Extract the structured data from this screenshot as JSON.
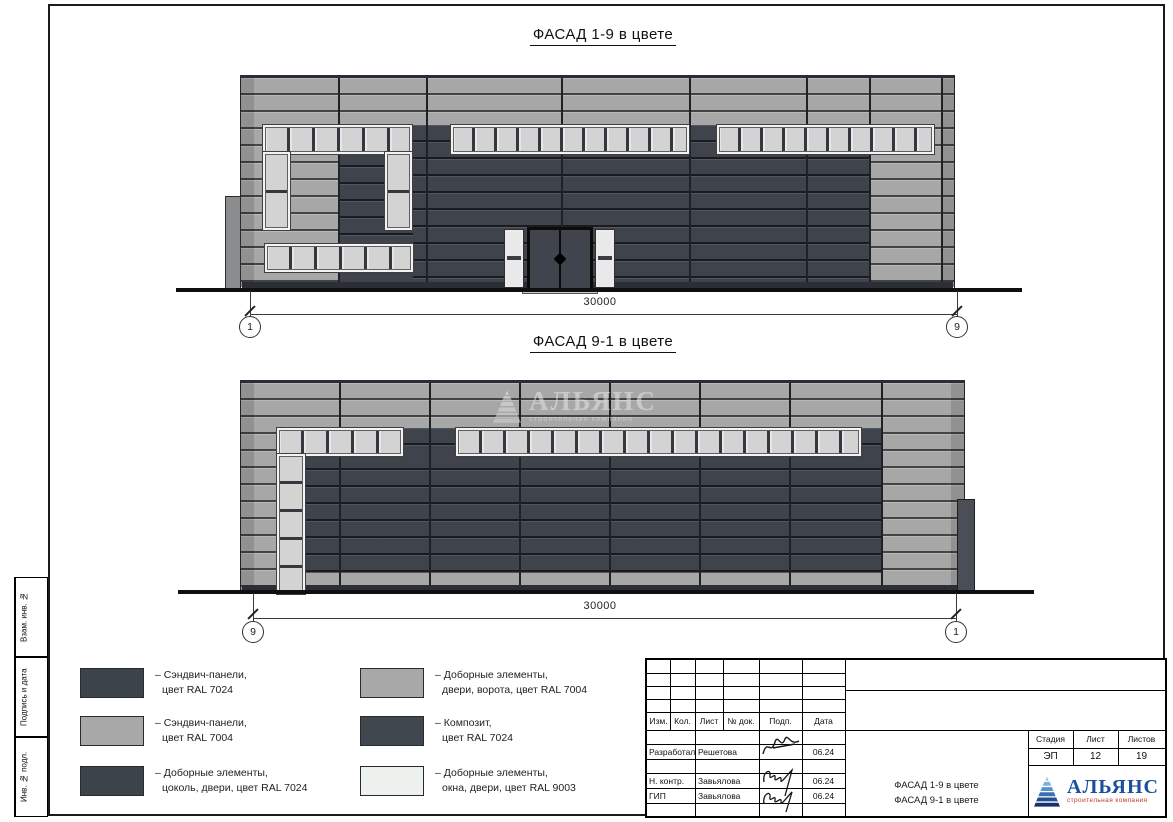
{
  "page": {
    "facades": [
      {
        "title": "ФАСАД 1-9 в цвете",
        "dimension": "30000",
        "axis_left": "1",
        "axis_right": "9"
      },
      {
        "title": "ФАСАД 9-1 в цвете",
        "dimension": "30000",
        "axis_left": "9",
        "axis_right": "1"
      }
    ],
    "watermark": {
      "name": "АЛЬЯНС",
      "subtitle": "строительная компания"
    }
  },
  "legend": {
    "left": [
      {
        "color": "#3d434b",
        "line1": "– Сэндвич-панели,",
        "line2": "цвет RAL 7024"
      },
      {
        "color": "#a8a8a8",
        "line1": "– Сэндвич-панели,",
        "line2": "цвет RAL 7004"
      },
      {
        "color": "#3d434b",
        "line1": "– Доборные элементы,",
        "line2": "цоколь, двери, цвет RAL 7024"
      }
    ],
    "right": [
      {
        "color": "#a8a8a8",
        "line1": "– Доборные элементы,",
        "line2": "двери, ворота, цвет RAL 7004"
      },
      {
        "color": "#41474f",
        "line1": "– Композит,",
        "line2": "цвет RAL 7024"
      },
      {
        "color": "#edf1ee",
        "line1": "– Доборные элементы,",
        "line2": "окна, двери, цвет RAL 9003"
      }
    ]
  },
  "titleblock": {
    "columns": [
      "Изм.",
      "Кол.",
      "Лист",
      "№ док.",
      "Подп.",
      "Дата"
    ],
    "rows": [
      {
        "role": "Разработал",
        "name": "Решетова",
        "date": "06.24"
      },
      {
        "role": "Н. контр.",
        "name": "Завьялова",
        "date": "06.24"
      },
      {
        "role": "ГИП",
        "name": "Завьялова",
        "date": "06.24"
      }
    ],
    "stage_label": "Стадия",
    "sheet_label": "Лист",
    "sheets_label": "Листов",
    "stage": "ЭП",
    "sheet_no": "12",
    "sheets_total": "19",
    "doc_title_line1": "ФАСАД 1-9 в цвете",
    "doc_title_line2": "ФАСАД 9-1 в цвете",
    "company": "АЛЬЯНС",
    "company_sub": "строительная компания"
  },
  "sidebar": {
    "labels": [
      "Взам. инв. №",
      "Подпись и дата",
      "Инв. № подл."
    ]
  },
  "colors": {
    "panel_light": "#a7a7a7",
    "panel_dark": "#3f444c",
    "window_glass": "#d3d3d3",
    "window_frame": "#f3f3f3",
    "ral9003": "#edf1ee",
    "logo_blue": "#1b4e9b",
    "logo_sub_red": "#c0392b"
  }
}
